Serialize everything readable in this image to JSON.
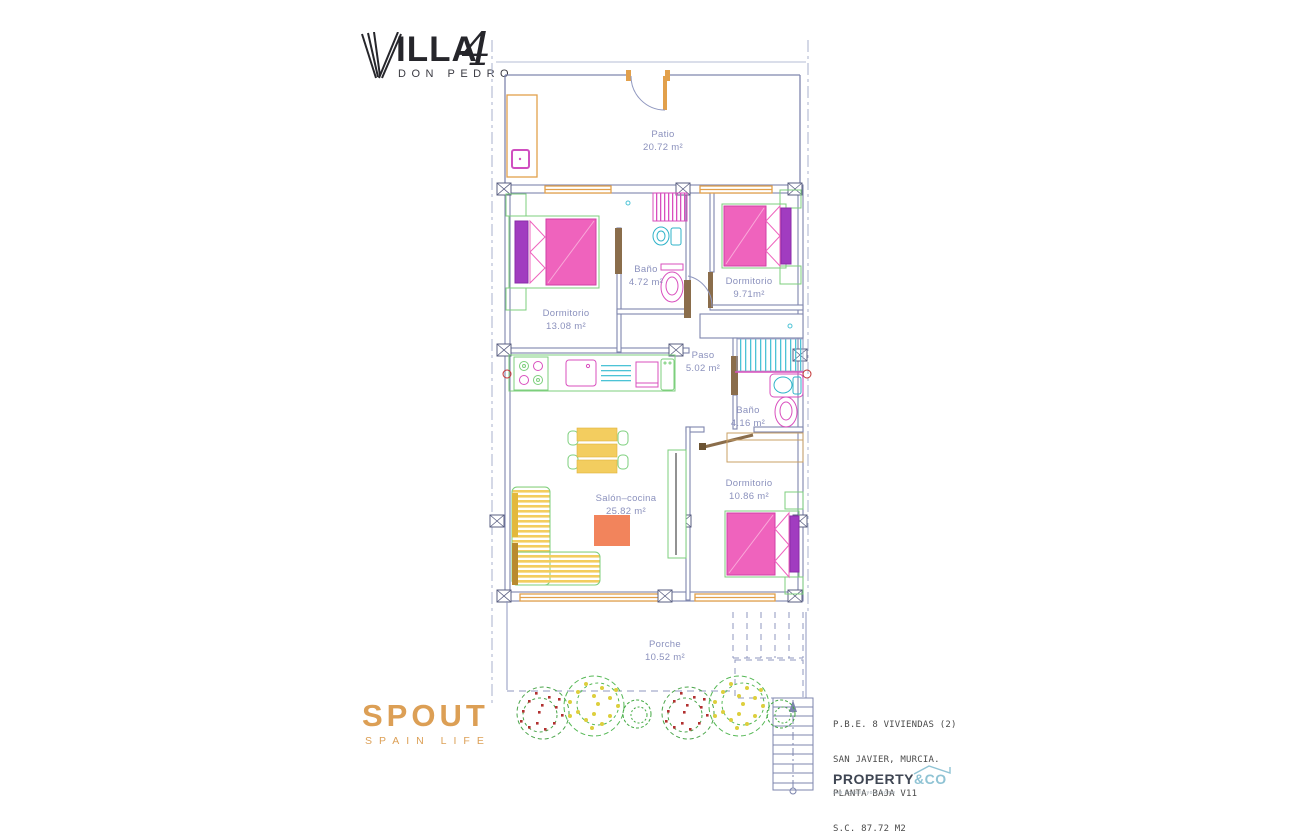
{
  "logo": {
    "brand": "ILLA",
    "letter_v": "V",
    "number": "4",
    "subtitle": "DON PEDRO"
  },
  "plan": {
    "rooms": [
      {
        "name": "Patio",
        "area": "20.72 m²"
      },
      {
        "name": "Dormitorio",
        "area": "13.08 m²"
      },
      {
        "name": "Baño",
        "area": "4.72 m²"
      },
      {
        "name": "Dormitorio",
        "area": "9.71m²"
      },
      {
        "name": "Paso",
        "area": "5.02 m²"
      },
      {
        "name": "Baño",
        "area": "4.16 m²"
      },
      {
        "name": "Dormitorio",
        "area": "10.86 m²"
      },
      {
        "name": "Salón–cocina",
        "area": "25.82 m²"
      },
      {
        "name": "Porche",
        "area": "10.52 m²"
      }
    ]
  },
  "agency": {
    "brand": "SPOUT",
    "tagline": "SPAIN LIFE"
  },
  "project": {
    "line1": "P.B.E. 8 VIVIENDAS (2)",
    "line2": "SAN JAVIER, MURCIA.",
    "line3": "PLANTA BAJA V11",
    "line4": "S.C. 87.72 M2"
  },
  "developer": {
    "brand_primary": "PROPERTY",
    "brand_secondary": "&CO",
    "tagline": "sun houses your home"
  },
  "colors": {
    "wall": "#7f86ae",
    "boundary": "#a8b0cc",
    "label": "#8b91bd",
    "orange": "#e2a04b",
    "tan": "#caa064",
    "pink": "#ef63bd",
    "magenta": "#d94fbe",
    "purple": "#a13cc0",
    "green": "#7ccf7c",
    "cyan": "#4cc3d6",
    "yellow": "#f3cd5f",
    "rug": "#f2845c",
    "red": "#c23333",
    "brand_orange": "#dc9f55",
    "property_dark": "#3f4653",
    "property_blue": "#8fc3d4"
  }
}
